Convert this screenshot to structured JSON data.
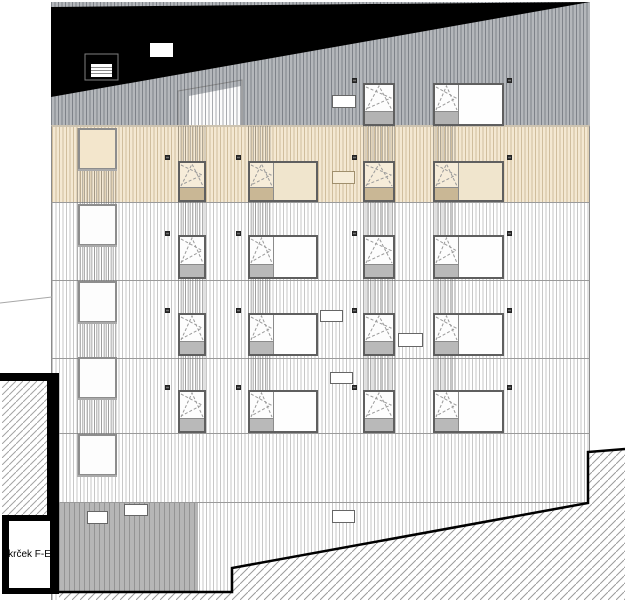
{
  "label": {
    "text": "krček F-E"
  },
  "colors": {
    "roof": "#000000",
    "gray_band": "#b4b7bb",
    "beige_band": "#f4e8d2",
    "facade": "#ffffff",
    "recess": "#b6b6b6",
    "frame": "#5f5f5f",
    "square_frame": "#8d8d8d",
    "vent_dark": "#3c3c3c",
    "hatch_line": "#9b9b9b",
    "ground_line": "#000000"
  },
  "window_variants": {
    "gray": {
      "glazing": "#fdfdfd",
      "spandrel": "#b3b3b3",
      "pane": "#fefefe",
      "square_fill": "#fdfdfd"
    },
    "beige": {
      "glazing": "#f6ecd9",
      "spandrel": "#c9b795",
      "pane": "#f0e5cd",
      "square_fill": "#f3e6cc"
    },
    "white": {
      "glazing": "#fdfdfd",
      "spandrel": "#b9b9b9",
      "pane": "#fefefe",
      "square_fill": "#fdfdfd"
    }
  },
  "windows": {
    "rows": [
      {
        "y": 83,
        "h": 43,
        "variant": "gray"
      },
      {
        "y": 161,
        "h": 41,
        "variant": "beige"
      },
      {
        "y": 235,
        "h": 44,
        "variant": "white"
      },
      {
        "y": 313,
        "h": 43,
        "variant": "white"
      },
      {
        "y": 390,
        "h": 43,
        "variant": "white"
      }
    ],
    "narrow_cols": [
      {
        "x": 178,
        "w": 28,
        "rows": [
          1,
          2,
          3,
          4
        ]
      },
      {
        "x": 363,
        "w": 32,
        "rows": [
          0,
          1,
          2,
          3,
          4
        ]
      }
    ],
    "wide_cols": [
      {
        "x": 248,
        "w": 70,
        "sash_w": 23,
        "rows": [
          1,
          2,
          3,
          4
        ]
      },
      {
        "x": 433,
        "w": 71,
        "sash_w": 23,
        "rows": [
          0,
          1,
          2,
          3,
          4
        ]
      }
    ],
    "squares": {
      "x": 78,
      "w": 39,
      "h": 42,
      "ys": [
        128,
        204,
        281,
        357,
        434
      ],
      "variants": [
        "beige",
        "white",
        "white",
        "white",
        "white"
      ]
    }
  },
  "vents": {
    "size": 5,
    "positions": [
      [
        352,
        78
      ],
      [
        507,
        78
      ],
      [
        165,
        155
      ],
      [
        236,
        155
      ],
      [
        352,
        155
      ],
      [
        507,
        155
      ],
      [
        165,
        231
      ],
      [
        236,
        231
      ],
      [
        352,
        231
      ],
      [
        507,
        231
      ],
      [
        165,
        308
      ],
      [
        236,
        308
      ],
      [
        352,
        308
      ],
      [
        507,
        308
      ],
      [
        165,
        385
      ],
      [
        236,
        385
      ],
      [
        352,
        385
      ],
      [
        507,
        385
      ]
    ]
  },
  "signs": [
    {
      "x": 332,
      "y": 95,
      "w": 24,
      "h": 13,
      "variant": "white"
    },
    {
      "x": 332,
      "y": 171,
      "w": 23,
      "h": 13,
      "variant": "beige"
    },
    {
      "x": 320,
      "y": 310,
      "w": 23,
      "h": 12,
      "variant": "white"
    },
    {
      "x": 398,
      "y": 333,
      "w": 25,
      "h": 14,
      "variant": "white"
    },
    {
      "x": 330,
      "y": 372,
      "w": 23,
      "h": 12,
      "variant": "white"
    },
    {
      "x": 87,
      "y": 511,
      "w": 21,
      "h": 13,
      "variant": "white"
    },
    {
      "x": 124,
      "y": 504,
      "w": 24,
      "h": 12,
      "variant": "white"
    },
    {
      "x": 332,
      "y": 510,
      "w": 23,
      "h": 13,
      "variant": "white"
    }
  ],
  "dense_bands": [
    [
      77,
      128,
      41,
      349
    ],
    [
      178,
      126,
      28,
      307
    ],
    [
      248,
      126,
      23,
      307
    ],
    [
      363,
      126,
      32,
      307
    ],
    [
      433,
      126,
      23,
      307
    ]
  ],
  "entrance": {
    "panel": {
      "x": 77,
      "y": 529,
      "w": 41,
      "h": 61
    },
    "door": {
      "x": 145,
      "y": 528,
      "w": 33,
      "h": 64
    },
    "canopy": {
      "x": 129,
      "y": 521,
      "w": 64,
      "h": 6
    },
    "handle": {
      "x": 169,
      "y": 533,
      "w": 7,
      "h": 55
    }
  }
}
